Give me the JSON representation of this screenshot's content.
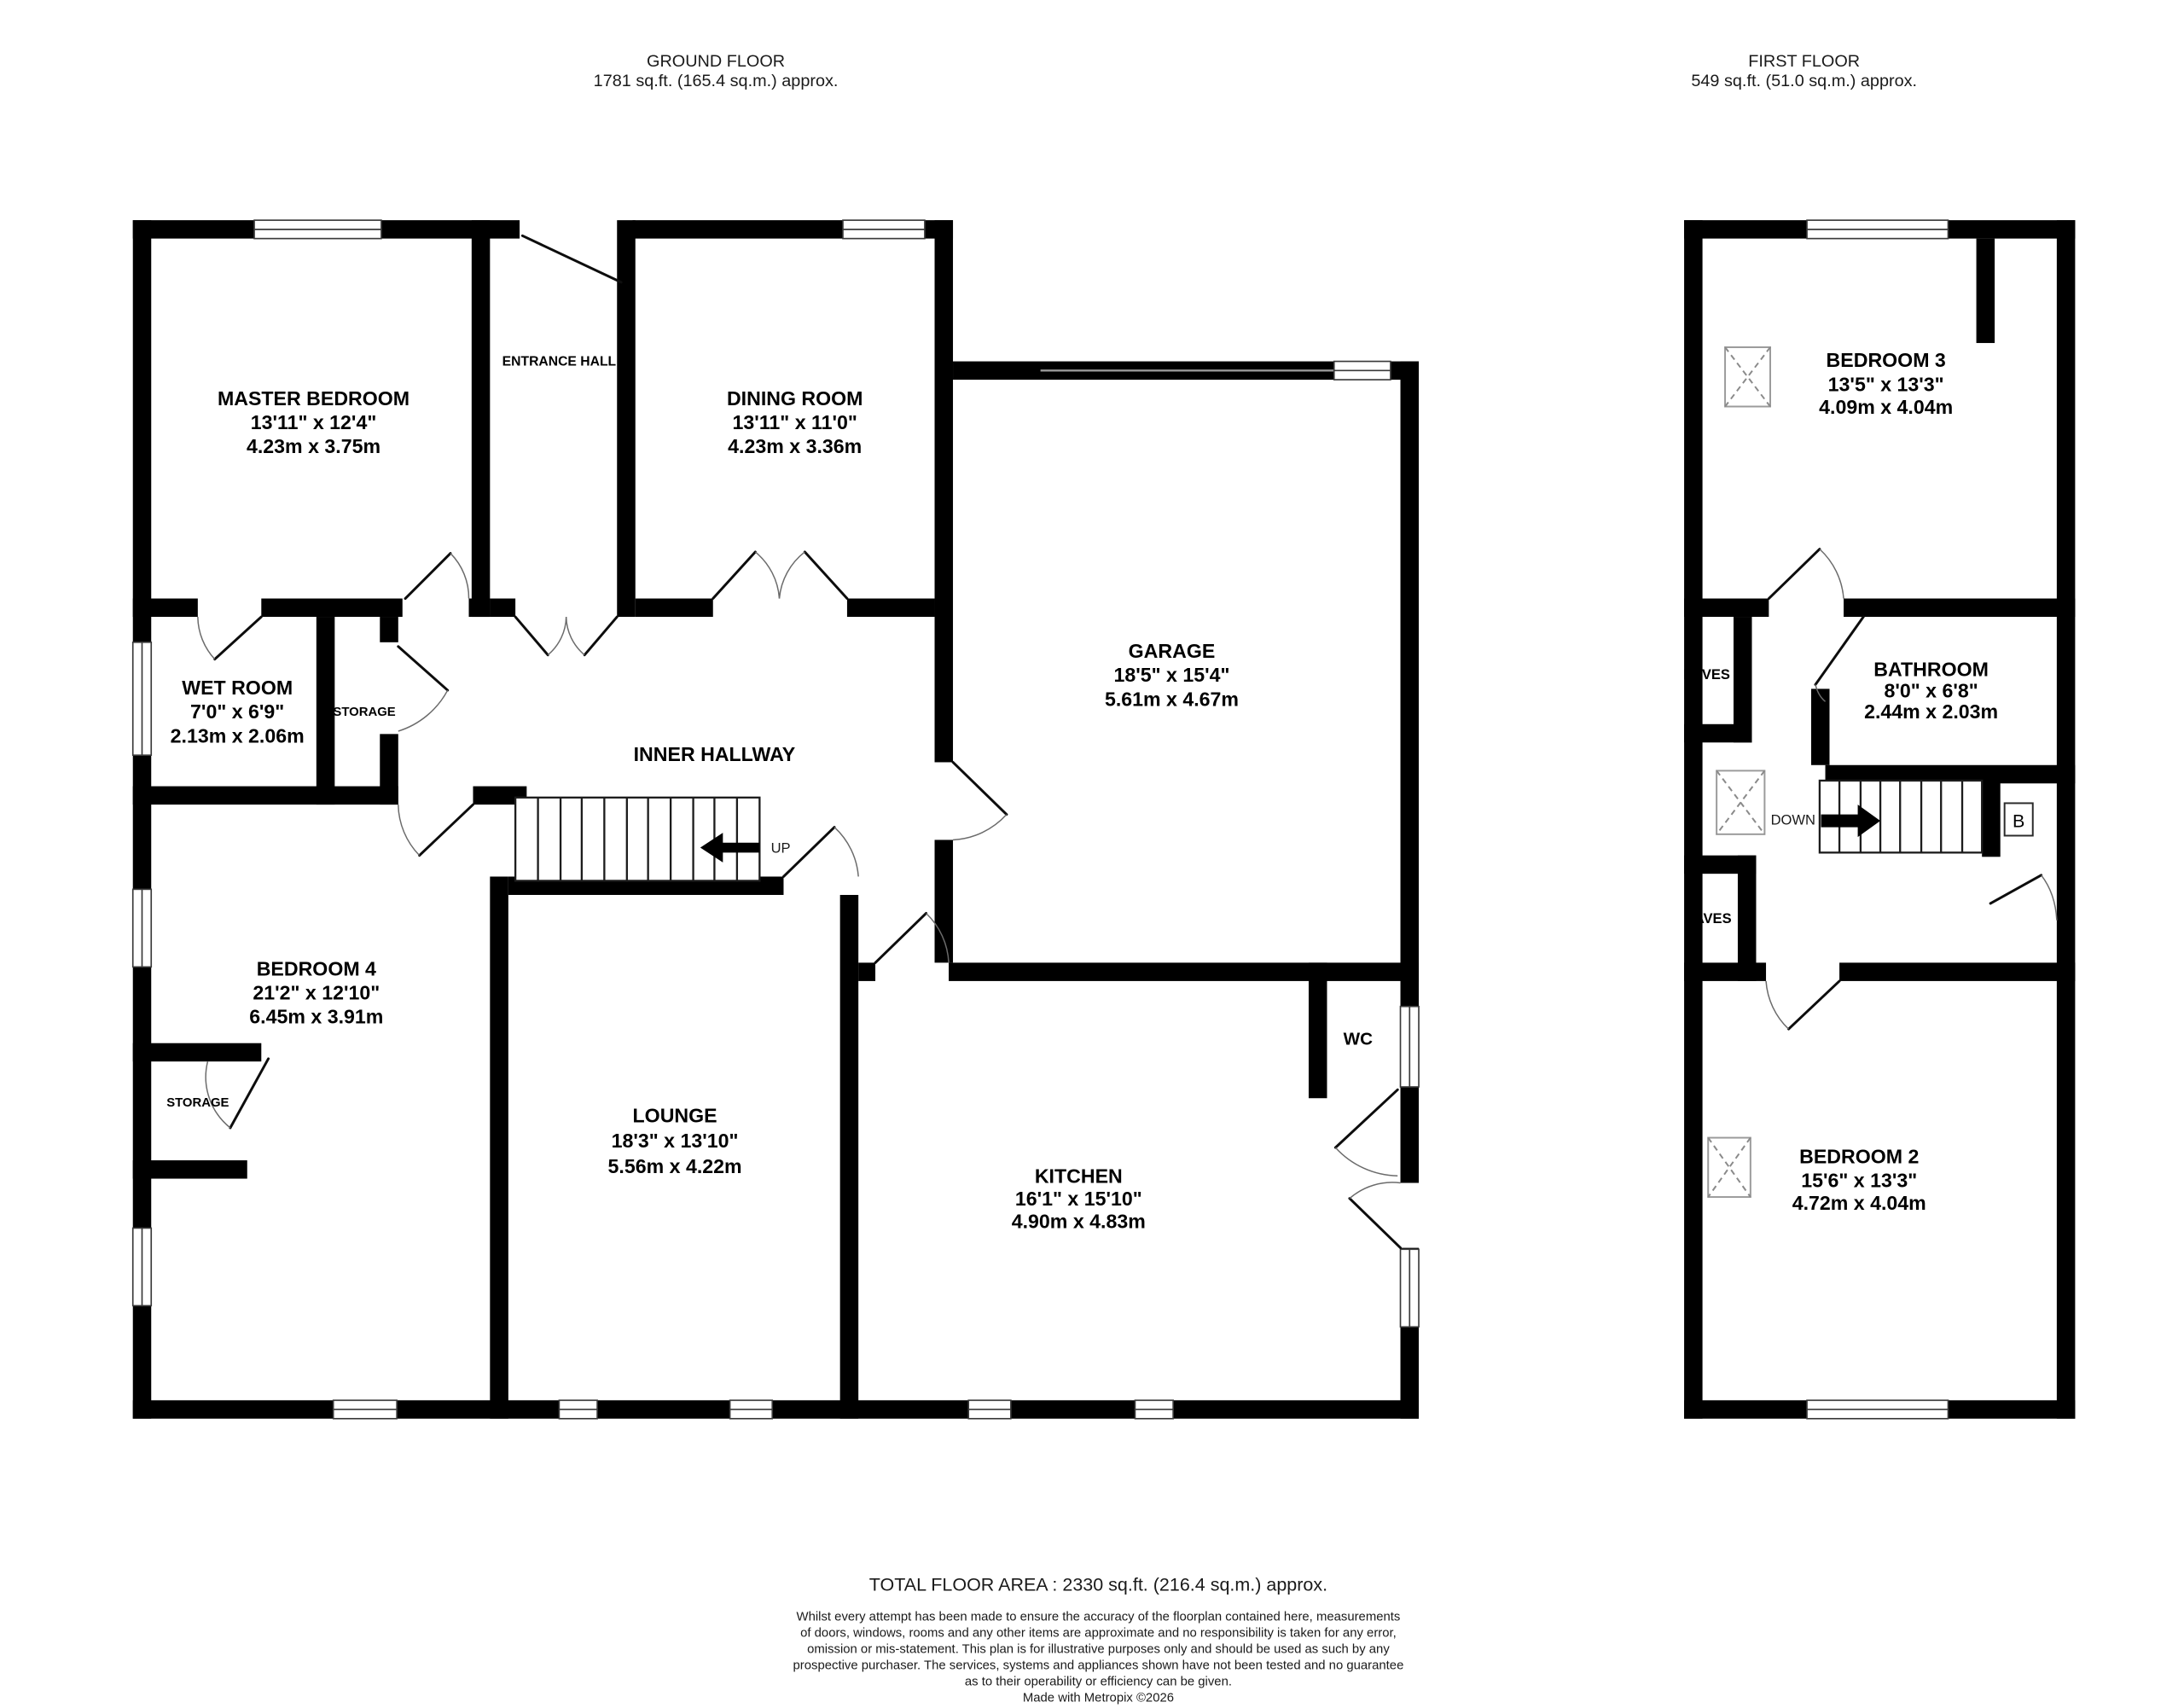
{
  "headers": {
    "ground": {
      "title": "GROUND FLOOR",
      "area": "1781 sq.ft. (165.4 sq.m.) approx."
    },
    "first": {
      "title": "FIRST FLOOR",
      "area": "549 sq.ft. (51.0 sq.m.) approx."
    }
  },
  "ground_floor": {
    "rooms": {
      "master_bedroom": {
        "name": "MASTER BEDROOM",
        "imperial": "13'11\"  x 12'4\"",
        "metric": "4.23m  x 3.75m"
      },
      "dining_room": {
        "name": "DINING ROOM",
        "imperial": "13'11\"  x 11'0\"",
        "metric": "4.23m  x 3.36m"
      },
      "garage": {
        "name": "GARAGE",
        "imperial": "18'5\"  x 15'4\"",
        "metric": "5.61m  x 4.67m"
      },
      "wet_room": {
        "name": "WET ROOM",
        "imperial": "7'0\"  x 6'9\"",
        "metric": "2.13m  x 2.06m"
      },
      "bedroom_4": {
        "name": "BEDROOM 4",
        "imperial": "21'2\"  x 12'10\"",
        "metric": "6.45m  x 3.91m"
      },
      "lounge": {
        "name": "LOUNGE",
        "imperial": "18'3\"  x 13'10\"",
        "metric": "5.56m  x 4.22m"
      },
      "kitchen": {
        "name": "KITCHEN",
        "imperial": "16'1\"  x 15'10\"",
        "metric": "4.90m  x 4.83m"
      }
    },
    "labels": {
      "entrance_hall": "ENTRANCE HALL",
      "inner_hallway": "INNER HALLWAY",
      "storage_top": "STORAGE",
      "storage_bottom": "STORAGE",
      "wc": "WC",
      "up": "UP"
    }
  },
  "first_floor": {
    "rooms": {
      "bedroom_3": {
        "name": "BEDROOM 3",
        "imperial": "13'5\"  x 13'3\"",
        "metric": "4.09m  x 4.04m"
      },
      "bathroom": {
        "name": "BATHROOM",
        "imperial": "8'0\"  x 6'8\"",
        "metric": "2.44m  x 2.03m"
      },
      "bedroom_2": {
        "name": "BEDROOM 2",
        "imperial": "15'6\"  x 13'3\"",
        "metric": "4.72m  x 4.04m"
      }
    },
    "labels": {
      "eaves_top": "EAVES",
      "eaves_bottom": "EAVES",
      "down": "DOWN",
      "boiler": "B"
    }
  },
  "footer": {
    "total": "TOTAL FLOOR AREA : 2330 sq.ft. (216.4 sq.m.) approx.",
    "disclaimer_lines": [
      "Whilst every attempt has been made to ensure the accuracy of the floorplan contained here, measurements",
      "of doors, windows, rooms and any other items are approximate and no responsibility is taken for any error,",
      "omission or mis-statement. This plan is for illustrative purposes only and should be used as such by any",
      "prospective purchaser. The services, systems and appliances shown have not been tested and no guarantee",
      "as to their operability or efficiency can be given."
    ],
    "credit": "Made with Metropix ©2026"
  },
  "colors": {
    "wall": "#000000",
    "text": "#000000",
    "background": "#ffffff"
  }
}
